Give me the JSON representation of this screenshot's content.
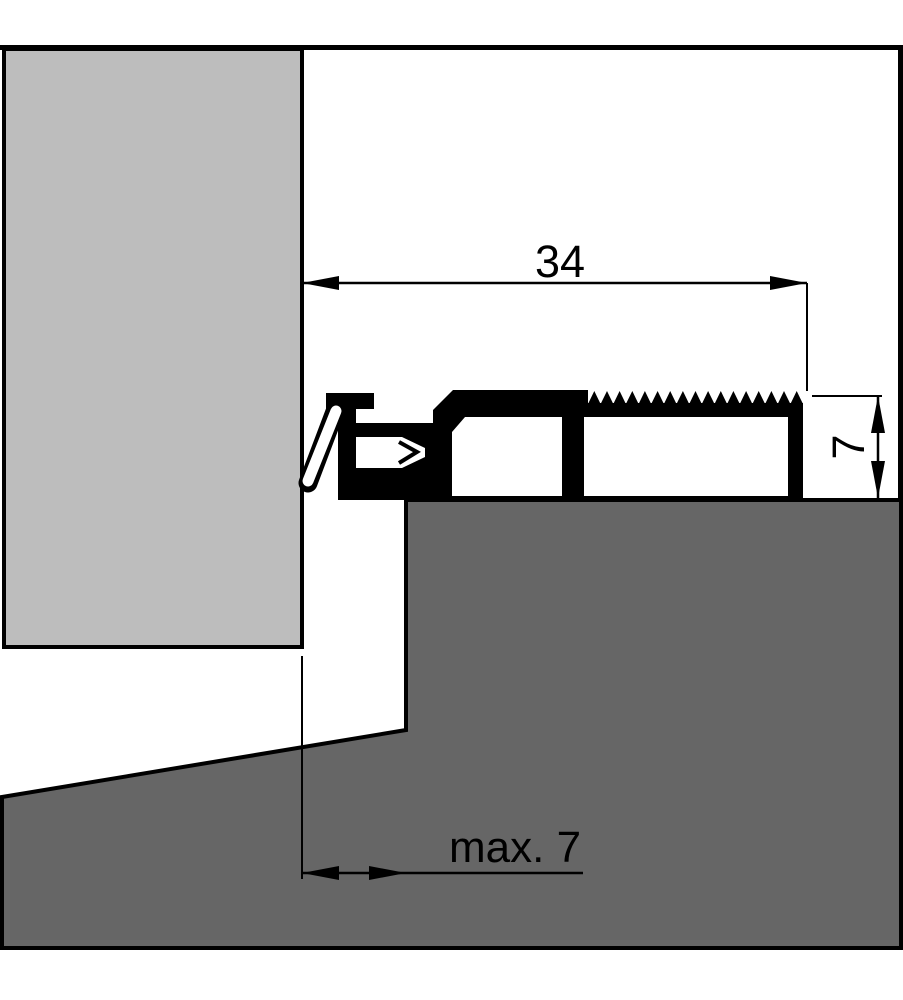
{
  "drawing": {
    "type": "threshold-profile-cross-section",
    "labels": {
      "width": "34",
      "height": "7",
      "clearance": "max. 7"
    },
    "colors": {
      "background": "#ffffff",
      "door": "#bdbdbd",
      "floor": "#666666",
      "ink": "#000000"
    }
  }
}
